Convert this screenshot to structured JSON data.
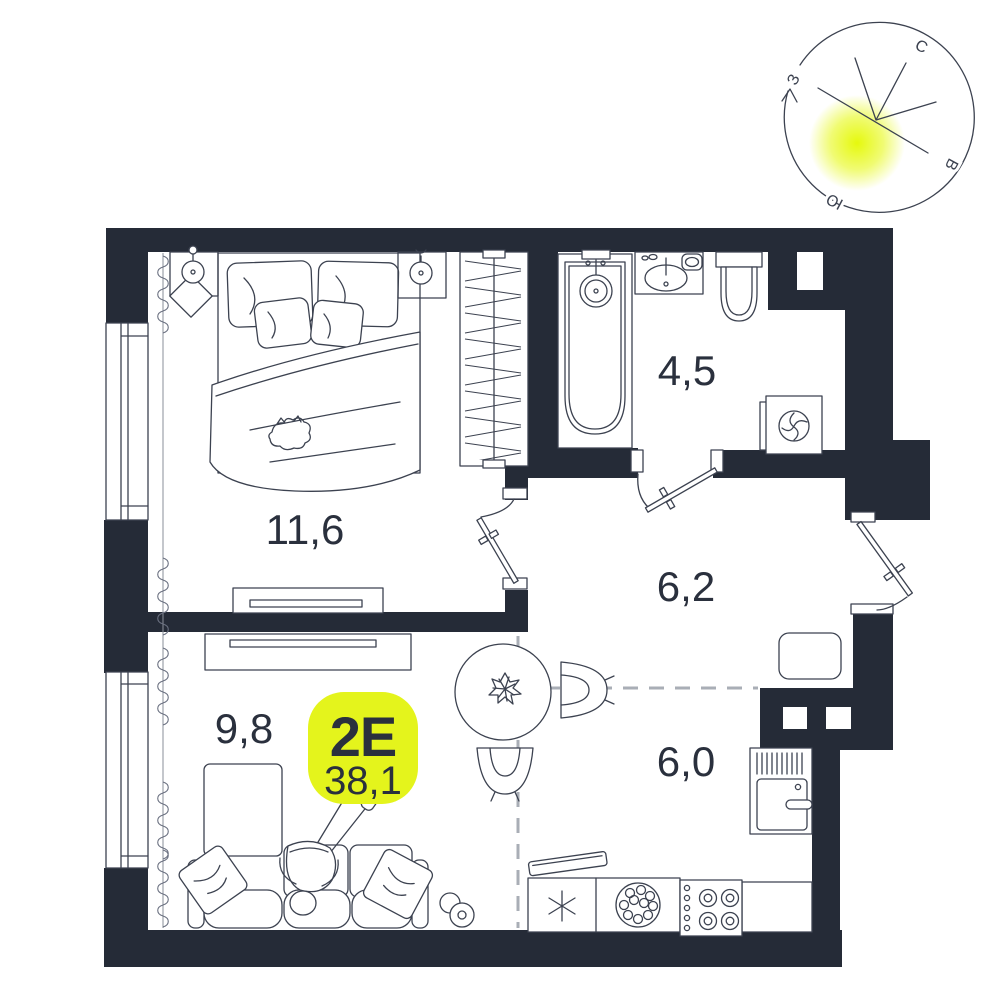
{
  "unit": {
    "type_label": "2Е",
    "total_area": "38,1"
  },
  "rooms": {
    "bedroom": {
      "area": "11,6"
    },
    "bathroom": {
      "area": "4,5"
    },
    "hallway": {
      "area": "6,2"
    },
    "living": {
      "area": "9,8"
    },
    "kitchen": {
      "area": "6,0"
    }
  },
  "compass": {
    "north": "С",
    "east": "В",
    "south": "Ю",
    "west": "З"
  },
  "colors": {
    "wall": "#252B37",
    "line": "#3C4250",
    "label_text": "#2A303D",
    "accent_yellow": "#E4F41C",
    "sun_glow": "#E4F800",
    "dashed_line": "#A9AEB6"
  }
}
